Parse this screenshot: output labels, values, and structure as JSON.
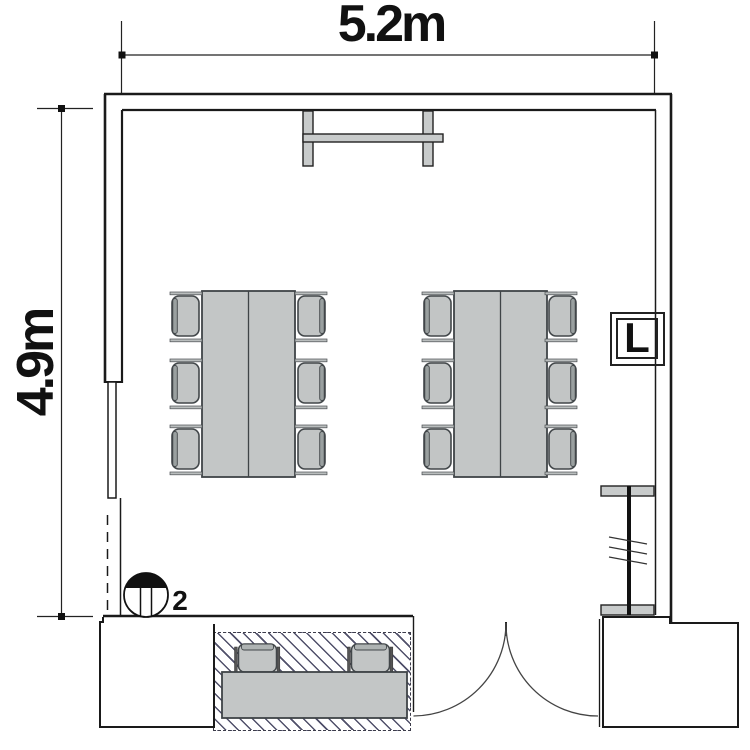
{
  "plan": {
    "title": "room-floor-plan",
    "dimensions": {
      "width_label": "5.2m",
      "height_label": "4.9m"
    },
    "markers": {
      "wall_box_label": "L",
      "round_symbol_label": "2"
    },
    "furniture": {
      "tables_count": 2,
      "seats_per_table": 6,
      "counter_seats": 2
    },
    "colors": {
      "line": "#1a1a1a",
      "furniture_fill": "#c3c6c6",
      "chair_fill": "#c2c5c5",
      "hatch_line": "#50506a",
      "bar_fill": "#c8cbcb"
    }
  }
}
